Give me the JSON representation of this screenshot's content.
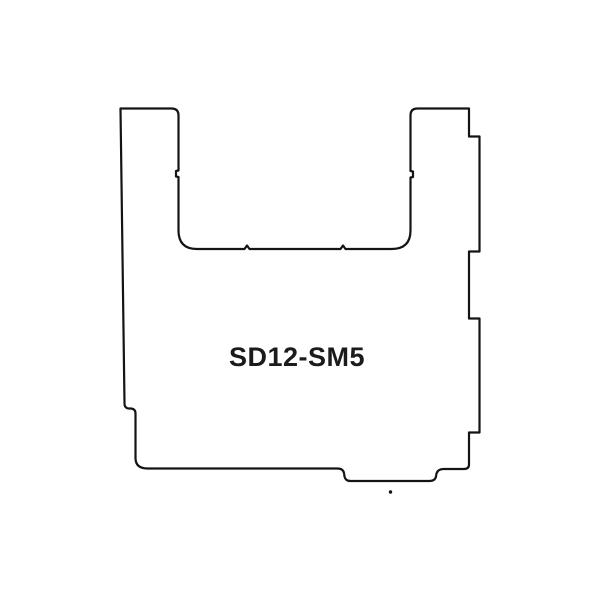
{
  "image": {
    "background_color": "#ffffff"
  },
  "drawing": {
    "label": "SD12-SM5",
    "outline_color": "#141414",
    "fill_color": "#ffffff",
    "label_color": "#1b1b1b",
    "stroke_width": "2.2"
  }
}
